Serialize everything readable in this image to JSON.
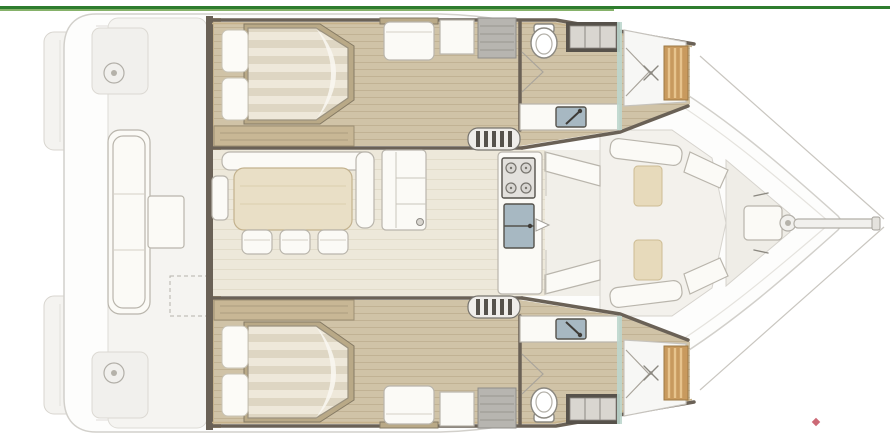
{
  "canvas": {
    "width": 890,
    "height": 446
  },
  "palette": {
    "green_dark": "#2e7d2e",
    "green_light": "#86b26a",
    "marker_red": "#c34f5e",
    "deck_fill": "#fdfdfc",
    "deck_stroke": "#d2d0cb",
    "wall_dark": "#6a6156",
    "wood_trim": "#c6b28b",
    "wood_floor": "#d0c3a7",
    "salon_floor": "#ede8da",
    "white_furniture": "#fbfaf6",
    "stroke_gray": "#b9b5ac",
    "table_wood": "#e9dfc6",
    "cushion_beige": "#e7dabb",
    "sink_blue": "#a7b8c2",
    "slat_wood": "#c89a5e",
    "glass": "#bcd6cd"
  },
  "diagram": {
    "type": "boat-floorplan",
    "vessel": "catamaran",
    "orientation": "bow-right-stern-left",
    "decorations": {
      "top_rule": "double-green-horizontal-line",
      "bottom_right_marker": "small-red-glyph"
    },
    "areas": [
      "aft-cockpit",
      "salon",
      "galley",
      "port-hull",
      "starboard-hull",
      "forward-cockpit",
      "bow"
    ],
    "features": {
      "port_hull": [
        "double-berth",
        "two-pillows",
        "seat",
        "lockers",
        "companionway-steps",
        "toilet",
        "wall-locker",
        "washbasin-with-faucet",
        "folding-door",
        "shower-with-drain",
        "teak-grating"
      ],
      "starboard_hull": [
        "double-berth",
        "two-pillows",
        "seat",
        "lockers",
        "companionway-steps",
        "toilet",
        "wall-locker",
        "washbasin-with-faucet",
        "folding-door",
        "shower-with-drain",
        "teak-grating"
      ],
      "salon": [
        "l-shaped-settee",
        "armrest",
        "dining-table",
        "three-stools",
        "cabinet-with-knob",
        "cooktop-four-burners",
        "double-sink",
        "forward-door-seats"
      ],
      "aft_cockpit": [
        "long-bench-three-cushions",
        "cockpit-table",
        "two-winches",
        "liferaft-locker-dashed",
        "transom-platforms"
      ],
      "forward_cockpit": [
        "benches",
        "two-seat-cushions",
        "bow-locker",
        "bow-fitting",
        "bowsprit",
        "two-rigging-lines"
      ]
    }
  }
}
